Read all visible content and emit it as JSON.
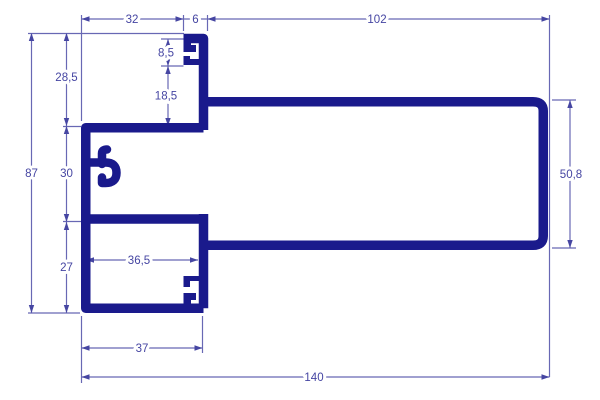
{
  "drawing": {
    "type": "aluminium-profile-cross-section",
    "colors": {
      "background": "#ffffff",
      "profile": "#1a1a8c",
      "dimension_line": "#6868b4",
      "dimension_text": "#4545a2"
    },
    "dims": {
      "d32": "32",
      "d6": "6",
      "d102": "102",
      "d85": "8,5",
      "d285": "28,5",
      "d185": "18,5",
      "d87": "87",
      "d30": "30",
      "d508": "50,8",
      "d365": "36,5",
      "d27": "27",
      "d37": "37",
      "d140": "140"
    },
    "dimension_list": [
      {
        "label": "32",
        "value": 32,
        "orientation": "horizontal",
        "location": "top"
      },
      {
        "label": "6",
        "value": 6,
        "orientation": "horizontal",
        "location": "top"
      },
      {
        "label": "102",
        "value": 102,
        "orientation": "horizontal",
        "location": "top"
      },
      {
        "label": "8,5",
        "value": 8.5,
        "orientation": "vertical",
        "location": "upper screw channel"
      },
      {
        "label": "18,5",
        "value": 18.5,
        "orientation": "vertical",
        "location": "upper screw channel to web"
      },
      {
        "label": "28,5",
        "value": 28.5,
        "orientation": "vertical",
        "location": "left chain"
      },
      {
        "label": "30",
        "value": 30,
        "orientation": "vertical",
        "location": "left chain"
      },
      {
        "label": "27",
        "value": 27,
        "orientation": "vertical",
        "location": "left chain"
      },
      {
        "label": "87",
        "value": 87,
        "orientation": "vertical",
        "location": "overall height"
      },
      {
        "label": "50,8",
        "value": 50.8,
        "orientation": "vertical",
        "location": "right box height"
      },
      {
        "label": "36,5",
        "value": 36.5,
        "orientation": "horizontal",
        "location": "lower chamber width"
      },
      {
        "label": "37",
        "value": 37,
        "orientation": "horizontal",
        "location": "bottom"
      },
      {
        "label": "140",
        "value": 140,
        "orientation": "horizontal",
        "location": "overall width"
      }
    ]
  }
}
